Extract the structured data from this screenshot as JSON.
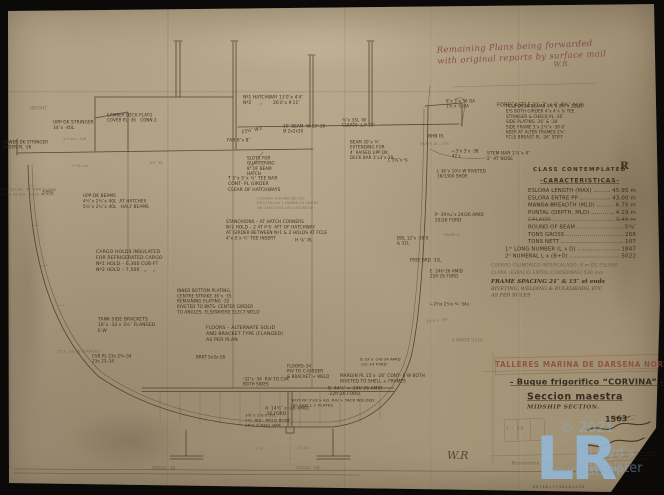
{
  "colors": {
    "paper": "#ae9f84",
    "ink": "#3a3021",
    "red_note": "#803e4e",
    "stamp_red": "#8a3c2e",
    "watermark_blue": "#92b6d4"
  },
  "note": {
    "line1": "Remaining Plans being forwarded",
    "line2": "with original reports by surface mail",
    "initials": "W.R."
  },
  "characteristics": {
    "header": "CLASS CONTEMPLATED",
    "class_symbol": "R",
    "title": "-CARACTERISTICAS-",
    "rows": [
      {
        "label": "ESLORA LENGTH (MAX)",
        "value": "45.95 m"
      },
      {
        "label": "ESLORA ENTRE PP",
        "value": "43.00 m"
      },
      {
        "label": "MANGA BREADTH (MLD)",
        "value": "6.75 m"
      },
      {
        "label": "PUNTAL (DEPTH, MLD)",
        "value": "4.19 m"
      },
      {
        "label": "CALADO",
        "value": "3.45 m",
        "struck": true
      },
      {
        "label": "ROUND OF BEAM",
        "value": "5⅝″"
      },
      {
        "label": "TONS GROSS",
        "value": "266"
      },
      {
        "label": "TONS NETT",
        "value": "107"
      },
      {
        "label": "1ˢᵗ LONG NUMBER (L x D)",
        "value": "1847",
        "indent": true
      },
      {
        "label": "2ᵈ NUMERAL L x (B+D)",
        "value": "5022",
        "indent": true
      }
    ],
    "notes": [
      {
        "t": "CUERPO CILINDRICO INTERCALADO: 8 m DE ESLORA",
        "c": "typed"
      },
      {
        "t": "CLARA (ESPACIO ENTRE CUADERNAS) 530 mm",
        "c": "typed"
      },
      {
        "t": "FRAME SPACING 21″ & 15″ at ends",
        "c": "hand"
      },
      {
        "t": "RIVETING, WELDING & BULKHEADS, ETC",
        "c": "hand2"
      },
      {
        "t": "AS PER RULES",
        "c": "hand2"
      }
    ]
  },
  "title_block": {
    "stamp": "TALLERES MARINA DE DARSENA NORTE",
    "title": "- Buque frigorifico “CORVINA” -",
    "subtitle": "Seccion maestra",
    "subtitle_en": "MIDSHIP SECTION.",
    "number": "1563",
    "scale": "1 : 20",
    "date": "Noviembre 19"
  },
  "watermark": {
    "logo": "LR",
    "copyright": "© 2021",
    "line1": "Lloyd's Register",
    "line2": "Foundation"
  },
  "annotations": [
    {
      "t": "Nº1 HATCHWAY 13′0″x 4′4″\nNº2      „       26′0″x 9′11″",
      "x": 243,
      "y": 95
    },
    {
      "t": "HEIGHT",
      "x": 30,
      "y": 98,
      "c": "faint"
    },
    {
      "t": "6″x 3″x 36 OA\n1⅝ x ⅞ BA",
      "x": 446,
      "y": 99,
      "s": 4
    },
    {
      "t": "FORECASTLE 21′-3″ x 6′-8¾″ high",
      "x": 497,
      "y": 96,
      "s": 5
    },
    {
      "t": "FCLE DECK·BEAMS 4½″x 2½″x 32L·S\nE/S BOTH GIRDER 4″x 4″x ⅜ TEE\nSTRINGER & CHECK PL ·26″\nSIDE PLATING ·26″ & ·30\nSIDE FRAME 5″x 2½″x ·30 6″\nKEEP AT ALTER FRAMES 2¾″\nFCLE BREAST PL ·26″ STIFF",
      "x": 506,
      "y": 104,
      "s": 4
    },
    {
      "t": "STEM BAR 1⅞″x 4″\n2″ AT NOSE",
      "x": 487,
      "y": 151,
      "s": 4.4
    },
    {
      "t": "23¾″ W.F.",
      "x": 241,
      "y": 118,
      "r": -10
    },
    {
      "t": "FAR 6″x 8″",
      "x": 227,
      "y": 130
    },
    {
      "t": "10″ BEAM  W 13″-26\nØ 2x2x30",
      "x": 283,
      "y": 124,
      "s": 4
    },
    {
      "t": "⅝″x 33L ·W\nCLEATS· L.P 33″",
      "x": 342,
      "y": 118,
      "s": 4
    },
    {
      "t": "BHB PL",
      "x": 428,
      "y": 126
    },
    {
      "t": "RIVETS 26 – 33½",
      "x": 420,
      "y": 133,
      "c": "faint",
      "s": 3.2
    },
    {
      "t": "BEAM 30″x ¾″\nEXTENDING FOR\n4″ RAISED UPP DK\nDECK BAR 3″x3″x·38",
      "x": 350,
      "y": 140,
      "s": 4
    },
    {
      "t": "∟3″x 3″x ·38\n42 L",
      "x": 452,
      "y": 149,
      "s": 4
    },
    {
      "t": "SLOTS FOR\nQUARTERING\n8″ OF BEAM\nHATCH",
      "x": 247,
      "y": 156,
      "s": 4
    },
    {
      "t": "T 5″x 5″x ½″ TEE BAR\nCONT· PL GIRDER\nCLEAR OF HATCHWAYS",
      "x": 228,
      "y": 176,
      "s": 4.4
    },
    {
      "t": "CUANDO ENCIMA DE LAS\nESCOTILLAS 1 HABRA LA UNION\nDE CASCO EN LAS CUB BETW",
      "x": 257,
      "y": 196,
      "c": "faint",
      "s": 3.6
    },
    {
      "t": "STANCHIONS – AT HATCH CORNERS\nNº2 HOLD – 2 AT P·S· AFT OF HATCHWAY\nAT GIRDER BETWEEN Nº1 & 2 HOLDS AT FCLE\n4″x 5″x ½″ TEE INSERT",
      "x": 226,
      "y": 219,
      "s": 4.2
    },
    {
      "t": "UPP·DK STRINGER\n34″x ·40L",
      "x": 53,
      "y": 120
    },
    {
      "t": "CAMBER DECK PLATG\nCOVER PL ·36   CONN 2",
      "x": 107,
      "y": 113,
      "s": 4
    },
    {
      "t": "LOWER DK STRINGER\nSHEER PL ·26",
      "x": 3,
      "y": 140,
      "s": 4
    },
    {
      "t": "3′6⅛″",
      "x": 42,
      "y": 182
    },
    {
      "t": "UPP·DK BEAMS\n4½″x 2½″x 40L  AT HATCHES\n5¾″x 2¾″x 40L  ·HALF BEAMS",
      "x": 83,
      "y": 193,
      "s": 4.2
    },
    {
      "t": "⅝″x 33·40L  Nº HATCH SIDE\n5¾″x 32·40L  HALF BEAMS",
      "x": 1,
      "y": 187,
      "c": "faint",
      "s": 3.8
    },
    {
      "t": "4·5 mm  438",
      "x": 63,
      "y": 128,
      "c": "faint",
      "s": 3.4
    },
    {
      "t": "2·94 mm",
      "x": 72,
      "y": 155,
      "c": "faint",
      "s": 3.4
    },
    {
      "t": "5′0″ 4B",
      "x": 150,
      "y": 152,
      "c": "faint",
      "s": 3.4
    },
    {
      "t": "L 3⅝″x ⅜",
      "x": 388,
      "y": 150,
      "s": 4
    },
    {
      "t": "L 36″x 10½ W RIVETED\n16/1300 SHOE",
      "x": 437,
      "y": 169,
      "s": 4
    },
    {
      "t": "P· 39⁹⁄₁₆″x 24/26 AMID\n25/26 FORD",
      "x": 435,
      "y": 212,
      "s": 4.2
    },
    {
      "t": "FRAME ⅞",
      "x": 444,
      "y": 224,
      "c": "faint",
      "s": 3.2
    },
    {
      "t": "H ⅞″ PL",
      "x": 295,
      "y": 230
    },
    {
      "t": "DBL 12″x ·26·S\n& 32L",
      "x": 397,
      "y": 236,
      "s": 4
    },
    {
      "t": "FREE BRD ·32L",
      "x": 410,
      "y": 250,
      "s": 4
    },
    {
      "t": "E ·24f/·26 AMID\n22f/·26 FORD",
      "x": 430,
      "y": 269,
      "s": 4
    },
    {
      "t": "∟2½x 2½x ¼ ·34s",
      "x": 430,
      "y": 294,
      "s": 4
    },
    {
      "t": "16⅞ x ·34",
      "x": 426,
      "y": 309,
      "c": "faint",
      "s": 4,
      "r": -6
    },
    {
      "t": "4 BRKTS ⅞x16",
      "x": 452,
      "y": 330,
      "c": "faint",
      "s": 4
    },
    {
      "t": "CARGO HOLDS INSULATED\nFOR REFRIGERATED CARGO\nNº1 HOLD – 6,300 CUB·FT\nNº2 HOLD – 7,500   „    „",
      "x": 96,
      "y": 249,
      "s": 4.6
    },
    {
      "t": "TANK SIDE BRACKETS\n18″x ·32 x 3½″ FLANGED\nE·W",
      "x": 98,
      "y": 317,
      "s": 4.4
    },
    {
      "t": "INNER BOTTOM PLATING,\nCENTRE STRAKE 36″x ·35\nREMAINING PLATING ·32\nRIVETED TO BKTS· CENTER GIRDER\nTO ANGLES, ELSEWHERE ELECT·WELD",
      "x": 177,
      "y": 288,
      "s": 4.1
    },
    {
      "t": "FLOORS – ALTERNATE SOLID\nAND BRACKET TYPE (FLANGED)\nAS PER PLAN",
      "x": 206,
      "y": 325,
      "s": 4.7
    },
    {
      "t": "BRKT 5x3x·26",
      "x": 196,
      "y": 347,
      "s": 4
    },
    {
      "t": "15″x ·32·35 FLANGED",
      "x": 57,
      "y": 341,
      "c": "faint",
      "s": 3.8
    },
    {
      "t": "CVK PL 23x 2¾–34\n23x 23–34",
      "x": 92,
      "y": 354,
      "s": 4
    },
    {
      "t": "FLOORS–34\nRIV TO C·GIRDER\n& BRACKET + WELD",
      "x": 287,
      "y": 364,
      "s": 4
    },
    {
      "t": "D 33″x ·24/·34 AMID\n·22/·34 FORD",
      "x": 360,
      "y": 357,
      "s": 3.8
    },
    {
      "t": "·32″x ·34  RIV TO CVK\nBOTH SIDES",
      "x": 243,
      "y": 377,
      "s": 4
    },
    {
      "t": "MARGIN PL 15″x ·26″ CONT· E·W BOTH\nRIVETED TO SHELL + FRAMES",
      "x": 340,
      "y": 373,
      "s": 4.2
    },
    {
      "t": "B· 44½″ x ·24f/·26 AMID\n·22f/·26 FORD",
      "x": 328,
      "y": 386,
      "s": 4.3
    },
    {
      "t": "BOT·FR 3″x3″x 42L RIV + TACK WELDED\nTO SHELL + PLATES",
      "x": 292,
      "y": 398,
      "s": 3.9
    },
    {
      "t": "A· 14½″ x ·26 AMID\n·26 FORD",
      "x": 265,
      "y": 406,
      "s": 4.3
    },
    {
      "t": "3½″x 2⅞″x 37L\n1⅛″ RIV · WELD BODY\n10″x ½ KEEL BAR",
      "x": 245,
      "y": 413,
      "s": 3.9
    },
    {
      "t": "LENGTH EXTR",
      "x": 533,
      "y": 193,
      "c": "faint",
      "s": 3
    },
    {
      "t": "3′10″",
      "x": 255,
      "y": 438,
      "c": "faint",
      "s": 3.4
    },
    {
      "t": "4′11⅛″",
      "x": 298,
      "y": 437,
      "c": "faint",
      "s": 3.4
    },
    {
      "t": "GRADA  AB",
      "x": 152,
      "y": 458,
      "c": "faint",
      "s": 4
    },
    {
      "t": "GRADA  GB",
      "x": 296,
      "y": 458,
      "c": "faint",
      "s": 4
    },
    {
      "t": "W.R",
      "x": 447,
      "y": 449,
      "s": 11,
      "c": "script"
    },
    {
      "t": "60746=074648=026",
      "x": 533,
      "y": 476,
      "s": 3.4,
      "c": "code"
    }
  ]
}
